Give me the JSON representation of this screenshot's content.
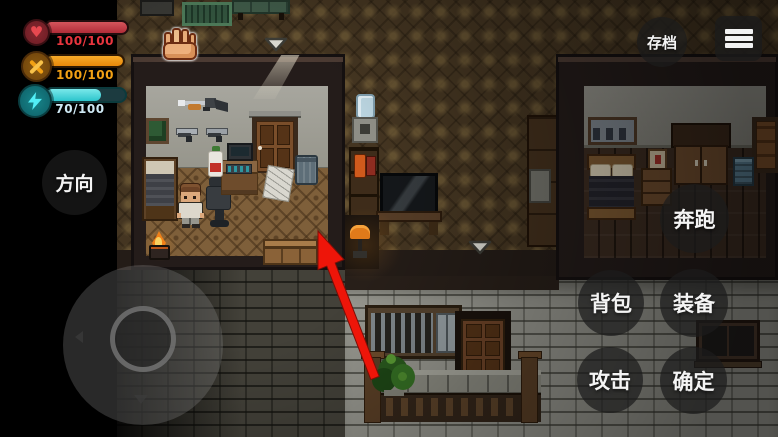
{
  "colors": {
    "hud_button_bg": "rgba(30,30,30,0.72)",
    "health_fill": "#c23a44",
    "health_text": "#e8353e",
    "tools_fill": "#f09a12",
    "tools_text": "#f2a114",
    "energy_fill": "#3fd4d8",
    "energy_text": "#cfe9f4",
    "tutorial_arrow": "#ee1509"
  },
  "hud": {
    "stats": [
      {
        "name": "health",
        "icon": "heart-icon",
        "value": "100/100",
        "percent": 100
      },
      {
        "name": "tools",
        "icon": "hammer-wrench-icon",
        "value": "100/100",
        "percent": 100
      },
      {
        "name": "energy",
        "icon": "lightning-icon",
        "value": "70/100",
        "percent": 70
      }
    ],
    "save_button": {
      "label": "存档"
    },
    "menu_button": {
      "icon": "hamburger-menu-icon"
    },
    "direction_button": {
      "label": "方向"
    },
    "action_buttons": [
      {
        "id": "run",
        "label": "奔跑"
      },
      {
        "id": "backpack",
        "label": "背包"
      },
      {
        "id": "equipment",
        "label": "装备"
      },
      {
        "id": "attack",
        "label": "攻击"
      },
      {
        "id": "confirm",
        "label": "确定"
      }
    ]
  },
  "scene": {
    "exit_markers": [
      {
        "icon": "down-arrow-marker"
      },
      {
        "icon": "down-arrow-marker"
      }
    ],
    "tutorial_arrow": {
      "icon": "red-arrow-icon",
      "direction": "up-left"
    },
    "punch_cursor": {
      "icon": "fist-icon"
    }
  }
}
